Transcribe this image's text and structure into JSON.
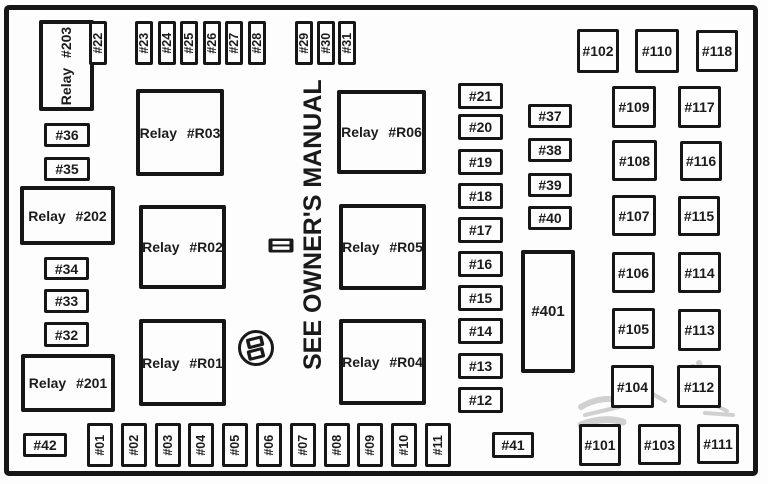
{
  "note": "SEE OWNER'S MANUAL",
  "colors": {
    "line": "#161616",
    "background": "#fdfdfd",
    "text": "#1c1c1c",
    "watermark": "#9b9b9b"
  },
  "icons": [
    "fuse-connector-icon",
    "fuse-puller-icon",
    "watermark-scribble"
  ],
  "boxes": [
    {
      "label": "Relay #203",
      "type": "relay-v",
      "x": 39,
      "y": 20,
      "w": 55,
      "h": 91
    },
    {
      "label": "#36",
      "type": "fh",
      "x": 44,
      "y": 123,
      "w": 46,
      "h": 24
    },
    {
      "label": "#35",
      "type": "fh",
      "x": 44,
      "y": 157,
      "w": 46,
      "h": 24
    },
    {
      "label": "Relay #202",
      "type": "relay",
      "x": 20,
      "y": 186,
      "w": 95,
      "h": 59
    },
    {
      "label": "#34",
      "type": "fh",
      "x": 44,
      "y": 257,
      "w": 45,
      "h": 23
    },
    {
      "label": "#33",
      "type": "fh",
      "x": 44,
      "y": 289,
      "w": 45,
      "h": 24
    },
    {
      "label": "#32",
      "type": "fh",
      "x": 44,
      "y": 322,
      "w": 45,
      "h": 25
    },
    {
      "label": "Relay #201",
      "type": "relay",
      "x": 21,
      "y": 354,
      "w": 94,
      "h": 58
    },
    {
      "label": "#42",
      "type": "fh",
      "x": 23,
      "y": 433,
      "w": 44,
      "h": 24
    },
    {
      "label": "Relay #R03",
      "type": "relay",
      "x": 136,
      "y": 89,
      "w": 88,
      "h": 87
    },
    {
      "label": "Relay #R02",
      "type": "relay",
      "x": 139,
      "y": 205,
      "w": 87,
      "h": 84
    },
    {
      "label": "Relay #R01",
      "type": "relay",
      "x": 139,
      "y": 319,
      "w": 87,
      "h": 87
    },
    {
      "label": "Relay #R06",
      "type": "relay",
      "x": 337,
      "y": 90,
      "w": 89,
      "h": 84
    },
    {
      "label": "Relay #R05",
      "type": "relay",
      "x": 339,
      "y": 204,
      "w": 87,
      "h": 86
    },
    {
      "label": "Relay #R04",
      "type": "relay",
      "x": 339,
      "y": 319,
      "w": 87,
      "h": 86
    },
    {
      "label": "#22",
      "type": "fv",
      "x": 89,
      "y": 21,
      "w": 18,
      "h": 44
    },
    {
      "label": "#23",
      "type": "fv",
      "x": 135,
      "y": 21,
      "w": 18,
      "h": 44
    },
    {
      "label": "#24",
      "type": "fv",
      "x": 158,
      "y": 21,
      "w": 18,
      "h": 44
    },
    {
      "label": "#25",
      "type": "fv",
      "x": 180,
      "y": 21,
      "w": 18,
      "h": 44
    },
    {
      "label": "#26",
      "type": "fv",
      "x": 203,
      "y": 21,
      "w": 18,
      "h": 44
    },
    {
      "label": "#27",
      "type": "fv",
      "x": 225,
      "y": 21,
      "w": 18,
      "h": 44
    },
    {
      "label": "#28",
      "type": "fv",
      "x": 248,
      "y": 21,
      "w": 18,
      "h": 44
    },
    {
      "label": "#29",
      "type": "fv",
      "x": 295,
      "y": 21,
      "w": 18,
      "h": 44
    },
    {
      "label": "#30",
      "type": "fv",
      "x": 317,
      "y": 21,
      "w": 18,
      "h": 44
    },
    {
      "label": "#31",
      "type": "fv",
      "x": 338,
      "y": 21,
      "w": 18,
      "h": 44
    },
    {
      "label": "#102",
      "type": "sq",
      "x": 577,
      "y": 29,
      "w": 42,
      "h": 44
    },
    {
      "label": "#110",
      "type": "sq",
      "x": 635,
      "y": 29,
      "w": 44,
      "h": 44
    },
    {
      "label": "#118",
      "type": "sq",
      "x": 696,
      "y": 30,
      "w": 42,
      "h": 42
    },
    {
      "label": "#21",
      "type": "fh",
      "x": 458,
      "y": 83,
      "w": 45,
      "h": 26
    },
    {
      "label": "#20",
      "type": "fh",
      "x": 458,
      "y": 114,
      "w": 45,
      "h": 26
    },
    {
      "label": "#19",
      "type": "fh",
      "x": 458,
      "y": 149,
      "w": 45,
      "h": 26
    },
    {
      "label": "#18",
      "type": "fh",
      "x": 458,
      "y": 183,
      "w": 45,
      "h": 26
    },
    {
      "label": "#17",
      "type": "fh",
      "x": 458,
      "y": 217,
      "w": 45,
      "h": 26
    },
    {
      "label": "#16",
      "type": "fh",
      "x": 458,
      "y": 251,
      "w": 45,
      "h": 26
    },
    {
      "label": "#15",
      "type": "fh",
      "x": 458,
      "y": 285,
      "w": 45,
      "h": 26
    },
    {
      "label": "#14",
      "type": "fh",
      "x": 458,
      "y": 318,
      "w": 45,
      "h": 26
    },
    {
      "label": "#13",
      "type": "fh",
      "x": 458,
      "y": 353,
      "w": 45,
      "h": 26
    },
    {
      "label": "#12",
      "type": "fh",
      "x": 458,
      "y": 387,
      "w": 45,
      "h": 26
    },
    {
      "label": "#37",
      "type": "fh",
      "x": 528,
      "y": 104,
      "w": 44,
      "h": 24
    },
    {
      "label": "#38",
      "type": "fh",
      "x": 528,
      "y": 138,
      "w": 44,
      "h": 24
    },
    {
      "label": "#39",
      "type": "fh",
      "x": 528,
      "y": 173,
      "w": 44,
      "h": 24
    },
    {
      "label": "#40",
      "type": "fh",
      "x": 528,
      "y": 206,
      "w": 44,
      "h": 24
    },
    {
      "label": "#401",
      "type": "tall",
      "x": 521,
      "y": 250,
      "w": 54,
      "h": 123
    },
    {
      "label": "#109",
      "type": "sq",
      "x": 612,
      "y": 86,
      "w": 44,
      "h": 42
    },
    {
      "label": "#108",
      "type": "sq",
      "x": 612,
      "y": 140,
      "w": 45,
      "h": 41
    },
    {
      "label": "#107",
      "type": "sq",
      "x": 612,
      "y": 195,
      "w": 44,
      "h": 41
    },
    {
      "label": "#106",
      "type": "sq",
      "x": 612,
      "y": 252,
      "w": 43,
      "h": 41
    },
    {
      "label": "#105",
      "type": "sq",
      "x": 612,
      "y": 308,
      "w": 43,
      "h": 41
    },
    {
      "label": "#104",
      "type": "sq",
      "x": 611,
      "y": 365,
      "w": 43,
      "h": 43
    },
    {
      "label": "#117",
      "type": "sq",
      "x": 678,
      "y": 86,
      "w": 43,
      "h": 42
    },
    {
      "label": "#116",
      "type": "sq",
      "x": 680,
      "y": 141,
      "w": 42,
      "h": 40
    },
    {
      "label": "#115",
      "type": "sq",
      "x": 678,
      "y": 196,
      "w": 42,
      "h": 40
    },
    {
      "label": "#114",
      "type": "sq",
      "x": 678,
      "y": 252,
      "w": 43,
      "h": 41
    },
    {
      "label": "#113",
      "type": "sq",
      "x": 678,
      "y": 309,
      "w": 43,
      "h": 42
    },
    {
      "label": "#112",
      "type": "sq",
      "x": 677,
      "y": 365,
      "w": 44,
      "h": 43
    },
    {
      "label": "#01",
      "type": "fv",
      "x": 87,
      "y": 423,
      "w": 26,
      "h": 44
    },
    {
      "label": "#02",
      "type": "fv",
      "x": 121,
      "y": 423,
      "w": 26,
      "h": 44
    },
    {
      "label": "#03",
      "type": "fv",
      "x": 155,
      "y": 423,
      "w": 26,
      "h": 44
    },
    {
      "label": "#04",
      "type": "fv",
      "x": 188,
      "y": 423,
      "w": 26,
      "h": 44
    },
    {
      "label": "#05",
      "type": "fv",
      "x": 222,
      "y": 423,
      "w": 26,
      "h": 44
    },
    {
      "label": "#06",
      "type": "fv",
      "x": 256,
      "y": 423,
      "w": 26,
      "h": 44
    },
    {
      "label": "#07",
      "type": "fv",
      "x": 290,
      "y": 423,
      "w": 26,
      "h": 44
    },
    {
      "label": "#08",
      "type": "fv",
      "x": 324,
      "y": 423,
      "w": 26,
      "h": 44
    },
    {
      "label": "#09",
      "type": "fv",
      "x": 357,
      "y": 423,
      "w": 26,
      "h": 44
    },
    {
      "label": "#10",
      "type": "fv",
      "x": 391,
      "y": 423,
      "w": 26,
      "h": 44
    },
    {
      "label": "#11",
      "type": "fv",
      "x": 425,
      "y": 423,
      "w": 26,
      "h": 44
    },
    {
      "label": "#41",
      "type": "fh",
      "x": 492,
      "y": 432,
      "w": 42,
      "h": 26
    },
    {
      "label": "#101",
      "type": "sq",
      "x": 579,
      "y": 424,
      "w": 42,
      "h": 42
    },
    {
      "label": "#103",
      "type": "sq",
      "x": 638,
      "y": 424,
      "w": 43,
      "h": 41
    },
    {
      "label": "#111",
      "type": "sq",
      "x": 697,
      "y": 424,
      "w": 42,
      "h": 40
    }
  ]
}
